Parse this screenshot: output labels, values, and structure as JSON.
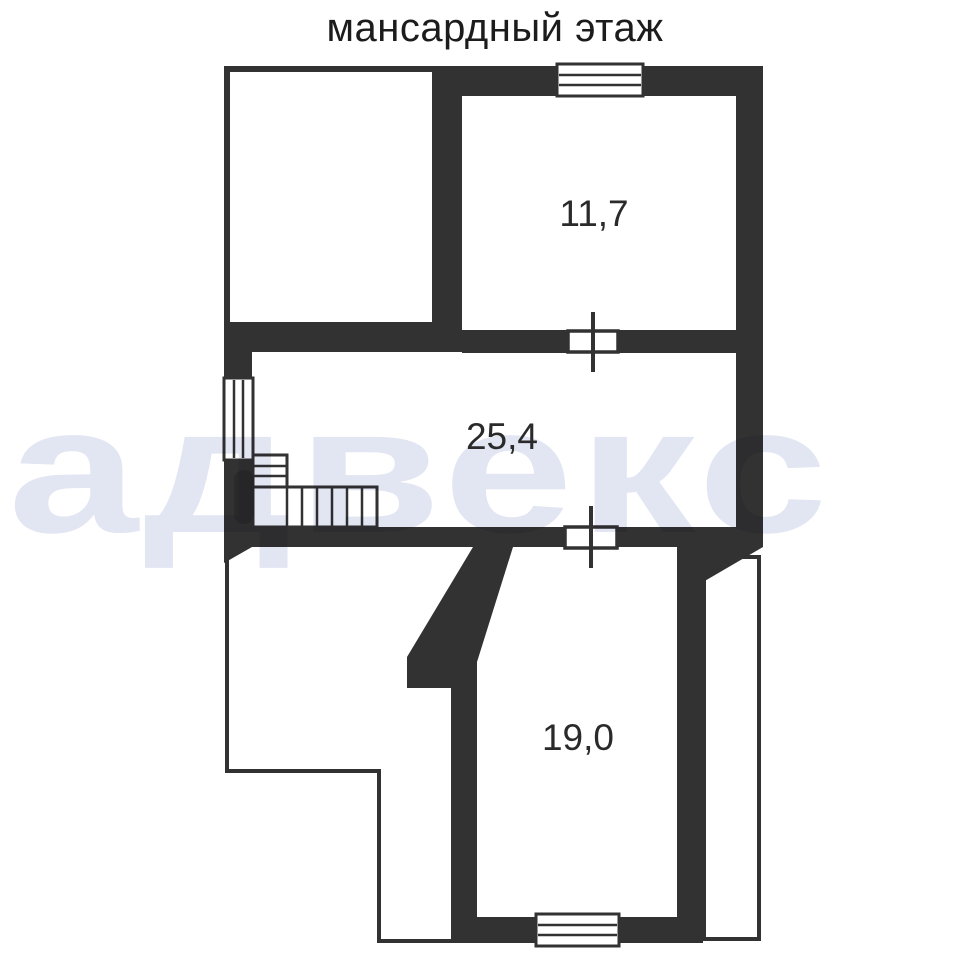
{
  "title": "мансардный этаж",
  "watermark_text": "адвекс",
  "rooms": [
    {
      "id": "room-upper-right",
      "area_label": "11,7"
    },
    {
      "id": "room-middle",
      "area_label": "25,4"
    },
    {
      "id": "room-lower",
      "area_label": "19,0"
    }
  ],
  "colors": {
    "wall": "#323232",
    "label": "#2a2a2a",
    "watermark": "#e2e5f2",
    "background": "#ffffff"
  }
}
